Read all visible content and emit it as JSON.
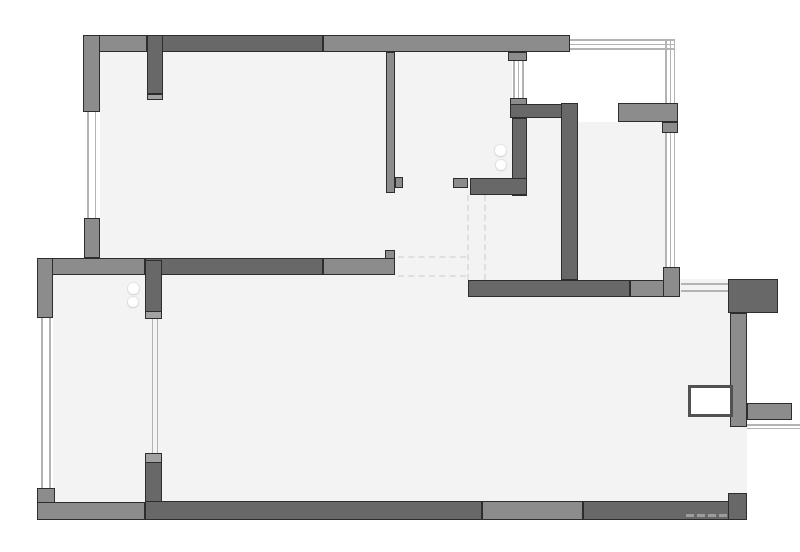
{
  "meta": {
    "drawing_type": "apartment floor plan",
    "visible_text": ""
  },
  "palette": {
    "white": "#ffffff",
    "floor": "#f3f3f4",
    "wall_medium": "#8c8c8c",
    "wall_dark": "#686868",
    "wall_cap": "#a2a2a2",
    "outline": "#2d2d2d",
    "window_line": "#b3b3b3",
    "dash": "#dfdfdf",
    "radiator_border": "#515151"
  },
  "canvas": {
    "width": 800,
    "height": 552
  },
  "layers": [
    {
      "type": "floor",
      "items": [
        {
          "n": "floor-room-top-left",
          "x": 100,
          "y": 52,
          "w": 286,
          "h": 206
        },
        {
          "n": "floor-room-top-mid",
          "x": 386,
          "y": 52,
          "w": 126,
          "h": 228
        },
        {
          "n": "floor-hall-mid",
          "x": 512,
          "y": 195,
          "w": 50,
          "h": 85
        },
        {
          "n": "floor-kitchen-nook",
          "x": 527,
          "y": 118,
          "w": 35,
          "h": 78
        },
        {
          "n": "floor-room-top-right",
          "x": 578,
          "y": 122,
          "w": 87,
          "h": 158
        },
        {
          "n": "floor-room-bottom",
          "x": 53,
          "y": 275,
          "w": 694,
          "h": 227
        }
      ]
    },
    {
      "type": "mask",
      "items": [
        {
          "n": "outside-top-right",
          "x": 570,
          "y": 0,
          "w": 230,
          "h": 103
        },
        {
          "n": "outside-right-upper",
          "x": 675,
          "y": 103,
          "w": 125,
          "h": 176
        },
        {
          "n": "outside-right-lower",
          "x": 747,
          "y": 279,
          "w": 53,
          "h": 221
        },
        {
          "n": "door-gap-balcony",
          "x": 579,
          "y": 104,
          "w": 39,
          "h": 17
        }
      ]
    },
    {
      "type": "dash",
      "items": [
        {
          "n": "dashed-opening-left-vertical",
          "x": 467,
          "y": 195,
          "w": 0,
          "h": 85
        },
        {
          "n": "dashed-opening-right-vertical",
          "x": 484,
          "y": 195,
          "w": 0,
          "h": 85
        },
        {
          "n": "dashed-opening-top-horizontal",
          "x": 398,
          "y": 256,
          "w": 68,
          "h": 0
        },
        {
          "n": "dashed-opening-bottom-horizontal",
          "x": 398,
          "y": 275,
          "w": 68,
          "h": 0
        }
      ]
    },
    {
      "type": "wline",
      "items": [
        {
          "n": "window-left-top-line",
          "x": 87,
          "y": 112,
          "w": 1.5,
          "h": 106
        },
        {
          "n": "window-left-top-line",
          "x": 94.5,
          "y": 112,
          "w": 1.5,
          "h": 106
        },
        {
          "n": "window-left-bottom-line",
          "x": 41,
          "y": 318,
          "w": 1.5,
          "h": 170
        },
        {
          "n": "window-left-bottom-line",
          "x": 49,
          "y": 318,
          "w": 1.5,
          "h": 170
        },
        {
          "n": "window-mid-line",
          "x": 151.5,
          "y": 319,
          "w": 1.5,
          "h": 134
        },
        {
          "n": "window-mid-line",
          "x": 156.5,
          "y": 319,
          "w": 1.5,
          "h": 134
        },
        {
          "n": "window-topmid-line",
          "x": 513,
          "y": 61,
          "w": 1.5,
          "h": 37
        },
        {
          "n": "window-topmid-line",
          "x": 517.5,
          "y": 61,
          "w": 1.5,
          "h": 37
        },
        {
          "n": "window-topmid-line",
          "x": 522,
          "y": 61,
          "w": 1.5,
          "h": 37
        },
        {
          "n": "balcony-top-line",
          "x": 570,
          "y": 39,
          "w": 104,
          "h": 1.5
        },
        {
          "n": "balcony-top-line",
          "x": 570,
          "y": 43.5,
          "w": 104,
          "h": 1.5
        },
        {
          "n": "balcony-top-line",
          "x": 570,
          "y": 48,
          "w": 104,
          "h": 1.5
        },
        {
          "n": "balcony-top-line-vertical",
          "x": 665,
          "y": 39,
          "w": 1.5,
          "h": 64
        },
        {
          "n": "balcony-top-line-vertical",
          "x": 669.5,
          "y": 39,
          "w": 1.5,
          "h": 64
        },
        {
          "n": "balcony-top-line-vertical",
          "x": 673.5,
          "y": 39,
          "w": 1.5,
          "h": 64
        },
        {
          "n": "window-right-line",
          "x": 665,
          "y": 133,
          "w": 1.5,
          "h": 134
        },
        {
          "n": "window-right-line",
          "x": 669.5,
          "y": 133,
          "w": 1.5,
          "h": 134
        },
        {
          "n": "window-right-line",
          "x": 673.5,
          "y": 133,
          "w": 1.5,
          "h": 134
        },
        {
          "n": "window-bottom-right-line",
          "x": 681,
          "y": 283,
          "w": 47,
          "h": 1.5
        },
        {
          "n": "window-bottom-right-line",
          "x": 681,
          "y": 290,
          "w": 47,
          "h": 1.5
        },
        {
          "n": "balcony-right-line",
          "x": 747,
          "y": 424,
          "w": 53,
          "h": 1.5
        },
        {
          "n": "balcony-right-line",
          "x": 747,
          "y": 427.5,
          "w": 53,
          "h": 1.5
        }
      ]
    },
    {
      "type": "wall",
      "items": [
        {
          "n": "wall-top-left-segment",
          "tone": "m",
          "x": 83,
          "y": 35,
          "w": 64,
          "h": 17
        },
        {
          "n": "wall-top-right-segment",
          "tone": "m",
          "x": 323,
          "y": 35,
          "w": 247,
          "h": 17
        },
        {
          "n": "wall-top-dark-segment",
          "tone": "d",
          "x": 147,
          "y": 35,
          "w": 176,
          "h": 17
        },
        {
          "n": "pier-top-left",
          "tone": "m",
          "x": 83,
          "y": 35,
          "w": 17,
          "h": 77
        },
        {
          "n": "wall-vertical-top-left",
          "tone": "d",
          "x": 147,
          "y": 35,
          "w": 16,
          "h": 59
        },
        {
          "n": "wall-cap-top-left",
          "tone": "c",
          "x": 147,
          "y": 94,
          "w": 16,
          "h": 6
        },
        {
          "n": "stub-top-center",
          "tone": "m",
          "x": 508,
          "y": 52,
          "w": 19,
          "h": 9
        },
        {
          "n": "stub-kitchen-top",
          "tone": "m",
          "x": 510,
          "y": 98,
          "w": 17,
          "h": 7
        },
        {
          "n": "partition-top-mid",
          "tone": "m",
          "x": 386,
          "y": 52,
          "w": 9,
          "h": 141
        },
        {
          "n": "partition-foot",
          "tone": "m",
          "x": 395,
          "y": 177,
          "w": 8,
          "h": 11
        },
        {
          "n": "wall-kitchen-top",
          "tone": "d",
          "x": 510,
          "y": 104,
          "w": 68,
          "h": 14
        },
        {
          "n": "wall-kitchen-left",
          "tone": "d",
          "x": 512,
          "y": 118,
          "w": 15,
          "h": 78
        },
        {
          "n": "wall-kitchen-bottom",
          "tone": "d",
          "x": 470,
          "y": 178,
          "w": 57,
          "h": 17
        },
        {
          "n": "stub-hallway",
          "tone": "m",
          "x": 453,
          "y": 178,
          "w": 15,
          "h": 10
        },
        {
          "n": "wall-kitchen-right",
          "tone": "d",
          "x": 561,
          "y": 103,
          "w": 17,
          "h": 177
        },
        {
          "n": "wall-balcony-top-right",
          "tone": "m",
          "x": 618,
          "y": 103,
          "w": 60,
          "h": 19
        },
        {
          "n": "wall-balcony-leg",
          "tone": "m",
          "x": 662,
          "y": 122,
          "w": 16,
          "h": 11
        },
        {
          "n": "pier-mid-left",
          "tone": "m",
          "x": 84,
          "y": 218,
          "w": 16,
          "h": 40
        },
        {
          "n": "wall-mid-left-segment",
          "tone": "m",
          "x": 37,
          "y": 258,
          "w": 108,
          "h": 17
        },
        {
          "n": "wall-mid-dark-segment",
          "tone": "d",
          "x": 145,
          "y": 258,
          "w": 178,
          "h": 17
        },
        {
          "n": "wall-mid-right-segment",
          "tone": "m",
          "x": 323,
          "y": 258,
          "w": 72,
          "h": 17
        },
        {
          "n": "wall-mid-end-notch",
          "tone": "m",
          "x": 385,
          "y": 250,
          "w": 10,
          "h": 9
        },
        {
          "n": "wall-left-upper",
          "tone": "m",
          "x": 37,
          "y": 258,
          "w": 16,
          "h": 60
        },
        {
          "n": "wall-vertical-mid-upper",
          "tone": "d",
          "x": 145,
          "y": 260,
          "w": 17,
          "h": 52
        },
        {
          "n": "wall-cap-mid-upper",
          "tone": "c",
          "x": 145,
          "y": 311,
          "w": 17,
          "h": 8
        },
        {
          "n": "wall-cap-mid-lower",
          "tone": "c",
          "x": 145,
          "y": 453,
          "w": 17,
          "h": 10
        },
        {
          "n": "wall-vertical-mid-lower",
          "tone": "d",
          "x": 145,
          "y": 462,
          "w": 17,
          "h": 40
        },
        {
          "n": "wall-bottom-right-room-dark",
          "tone": "d",
          "x": 468,
          "y": 280,
          "w": 162,
          "h": 17
        },
        {
          "n": "wall-bottom-right-room-med",
          "tone": "m",
          "x": 630,
          "y": 280,
          "w": 50,
          "h": 17
        },
        {
          "n": "pier-right",
          "tone": "m",
          "x": 663,
          "y": 267,
          "w": 17,
          "h": 30
        },
        {
          "n": "block-right",
          "tone": "d",
          "x": 728,
          "y": 279,
          "w": 50,
          "h": 34
        },
        {
          "n": "wall-right-lower",
          "tone": "m",
          "x": 730,
          "y": 313,
          "w": 17,
          "h": 114
        },
        {
          "n": "stub-right-balcony",
          "tone": "m",
          "x": 747,
          "y": 403,
          "w": 45,
          "h": 17
        },
        {
          "n": "pier-bottom-left",
          "tone": "m",
          "x": 37,
          "y": 488,
          "w": 18,
          "h": 32
        },
        {
          "n": "wall-bottom-left-segment",
          "tone": "m",
          "x": 37,
          "y": 502,
          "w": 108,
          "h": 18
        },
        {
          "n": "wall-bottom-dark-segment-1",
          "tone": "d",
          "x": 145,
          "y": 501,
          "w": 337,
          "h": 19
        },
        {
          "n": "wall-bottom-mid-segment",
          "tone": "m",
          "x": 482,
          "y": 501,
          "w": 101,
          "h": 19
        },
        {
          "n": "wall-bottom-dark-segment-2",
          "tone": "d",
          "x": 583,
          "y": 501,
          "w": 164,
          "h": 19
        },
        {
          "n": "wall-bottom-right-riser",
          "tone": "d",
          "x": 728,
          "y": 493,
          "w": 19,
          "h": 27
        }
      ]
    },
    {
      "type": "radiator",
      "items": [
        {
          "n": "radiator-box",
          "x": 688,
          "y": 385,
          "w": 45,
          "h": 32
        }
      ]
    },
    {
      "type": "dot",
      "items": [
        {
          "n": "marker-dot",
          "x": 128,
          "y": 283,
          "w": 11,
          "h": 11
        },
        {
          "n": "marker-dot",
          "x": 128,
          "y": 297,
          "w": 10,
          "h": 10
        },
        {
          "n": "marker-dot",
          "x": 495,
          "y": 145,
          "w": 11,
          "h": 11
        },
        {
          "n": "marker-dot",
          "x": 496,
          "y": 160,
          "w": 10,
          "h": 10
        }
      ]
    },
    {
      "type": "wmdash",
      "items": [
        {
          "n": "watermark-mark",
          "x": 686,
          "y": 514,
          "w": 8,
          "h": 3
        },
        {
          "n": "watermark-mark",
          "x": 697,
          "y": 514,
          "w": 8,
          "h": 3
        },
        {
          "n": "watermark-mark",
          "x": 708,
          "y": 514,
          "w": 8,
          "h": 3
        },
        {
          "n": "watermark-mark",
          "x": 719,
          "y": 514,
          "w": 8,
          "h": 3
        }
      ]
    }
  ]
}
